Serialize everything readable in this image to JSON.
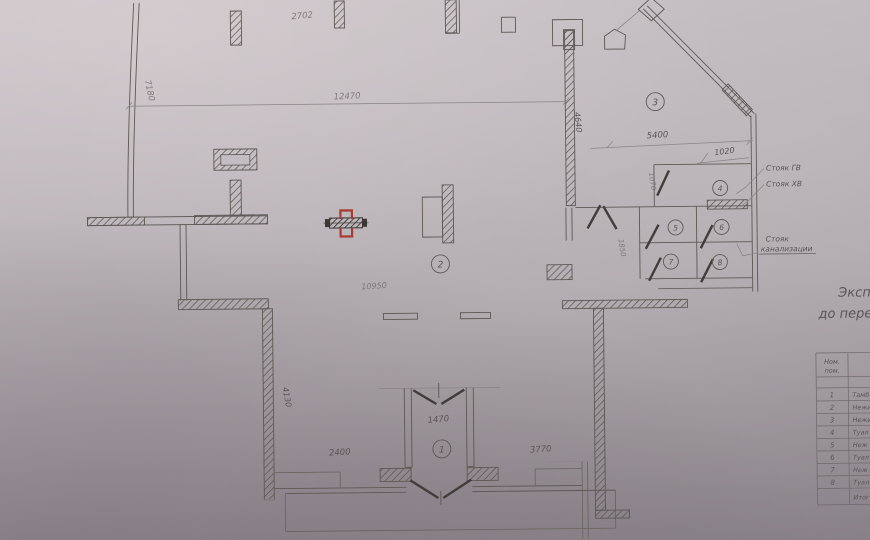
{
  "plan": {
    "room_numbers": [
      "1",
      "2",
      "3",
      "4",
      "5",
      "6",
      "7",
      "8"
    ],
    "dimensions": {
      "d2702": "2702",
      "d7180": "7180",
      "d12470": "12470",
      "d4640": "4640",
      "d5400": "5400",
      "d1020": "1020",
      "d1070": "1070",
      "d1850": "1850",
      "d10950": "10950",
      "d4130": "4130",
      "d2400": "2400",
      "d1470": "1470",
      "d3770": "3770"
    },
    "risers": {
      "gv": "Стояк ГВ",
      "hv": "Стояк ХВ",
      "sewer_line1": "Стояк",
      "sewer_line2": "канализации"
    },
    "title": {
      "line1": "Эксп",
      "line2": "до пере"
    },
    "table": {
      "header": {
        "line1": "Ном.",
        "line2": "пом."
      },
      "rows": [
        {
          "num": "1",
          "name": "Тамб"
        },
        {
          "num": "2",
          "name": "Нежи"
        },
        {
          "num": "3",
          "name": "Нежи"
        },
        {
          "num": "4",
          "name": "Туал"
        },
        {
          "num": "5",
          "name": "Неж"
        },
        {
          "num": "6",
          "name": "Туал"
        },
        {
          "num": "7",
          "name": "Неж"
        },
        {
          "num": "8",
          "name": "Туал"
        }
      ],
      "footer": "Итог"
    },
    "colors": {
      "paper": "#b7b0b5",
      "ink": "#5e5856",
      "red_mark": "#a83a31"
    }
  }
}
